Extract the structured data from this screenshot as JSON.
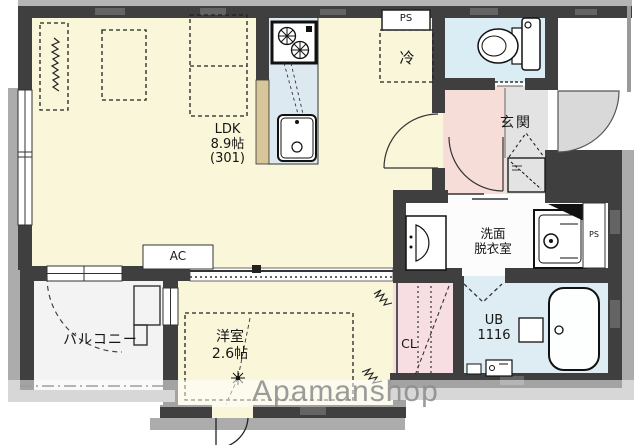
{
  "floorplan": {
    "watermark": "Apamanshop",
    "rooms": {
      "ldk": {
        "name": "LDK",
        "size": "8.9帖",
        "unit_number": "(301)"
      },
      "western_room": {
        "name": "洋室",
        "size": "2.6帖"
      },
      "balcony": {
        "name": "バルコニー"
      },
      "entrance": {
        "name": "玄関"
      },
      "washroom": {
        "name_line1": "洗面",
        "name_line2": "脱衣室"
      },
      "unit_bath": {
        "name": "UB",
        "size": "1116"
      },
      "closet": {
        "name": "CL"
      }
    },
    "equipment": {
      "refrigerator_space": "冷",
      "air_conditioner": "AC",
      "pipe_space_top": "PS",
      "pipe_space_side": "PS"
    },
    "colors": {
      "wall": "#3f3f3f",
      "ldk_floor": "#faf6da",
      "wet_area_floor": "#daecf4",
      "hall_floor": "#f6ddd8",
      "closet_floor": "#f6dee2",
      "entrance_floor": "#e3e3e3",
      "kitchen_counter": "#dde9f1",
      "watermark_text": "#8e8e8e"
    }
  }
}
